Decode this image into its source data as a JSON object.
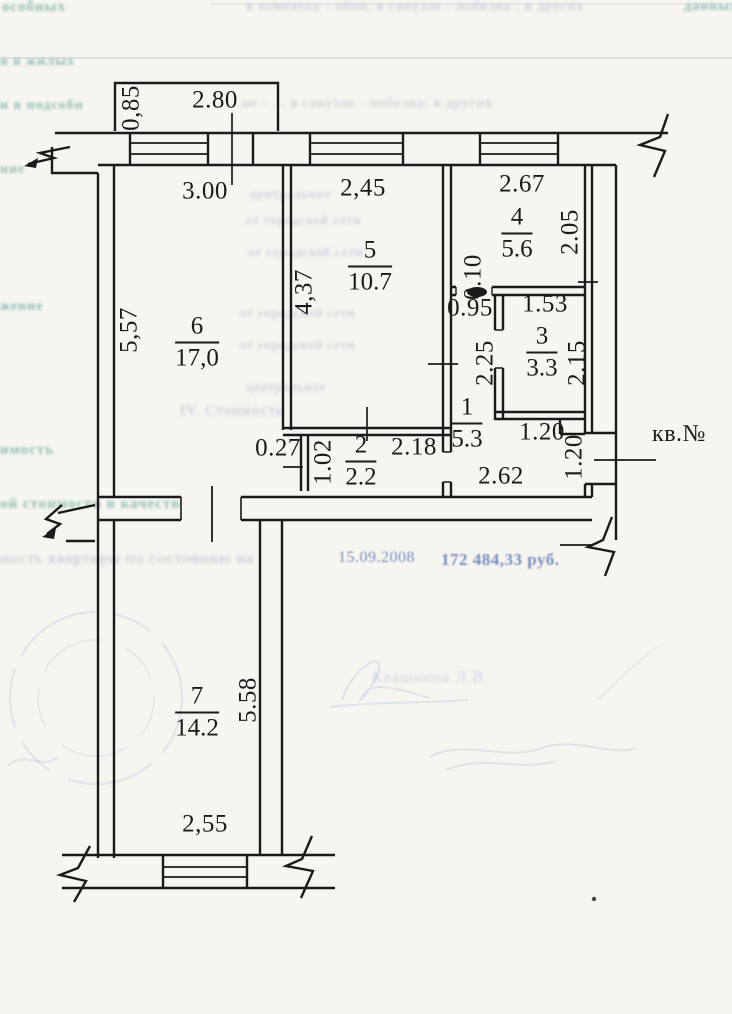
{
  "canvas": {
    "width": 732,
    "height": 1014,
    "paper_color": "#f7f5ef",
    "ink_color": "#1a1a1a",
    "bleed_teal": "#3d948d",
    "bleed_blue": "#8a99c9",
    "bleed_dark_blue": "#5570b4",
    "stamp_blue": "#7494cc"
  },
  "plan": {
    "apartment_label": {
      "text": "кв.№",
      "x": 679,
      "y": 434
    },
    "room_labels": [
      {
        "number": "6",
        "area": "17,0",
        "x": 197,
        "y": 342
      },
      {
        "number": "5",
        "area": "10.7",
        "x": 370,
        "y": 266
      },
      {
        "number": "4",
        "area": "5.6",
        "x": 517,
        "y": 233
      },
      {
        "number": "3",
        "area": "3.3",
        "x": 542,
        "y": 352
      },
      {
        "number": "1",
        "area": "5.3",
        "x": 467,
        "y": 423
      },
      {
        "number": "2",
        "area": "2.2",
        "x": 361,
        "y": 461
      },
      {
        "number": "7",
        "area": "14.2",
        "x": 197,
        "y": 712
      }
    ],
    "dimensions": [
      {
        "text": "0,85",
        "x": 131,
        "y": 108,
        "rot": -90
      },
      {
        "text": "2.80",
        "x": 215,
        "y": 100,
        "rot": 0
      },
      {
        "text": "3.00",
        "x": 205,
        "y": 191,
        "rot": 0
      },
      {
        "text": "2,45",
        "x": 363,
        "y": 188,
        "rot": 0
      },
      {
        "text": "2.67",
        "x": 522,
        "y": 184,
        "rot": 0
      },
      {
        "text": "4,37",
        "x": 304,
        "y": 292,
        "rot": -90
      },
      {
        "text": "5,57",
        "x": 129,
        "y": 330,
        "rot": -90
      },
      {
        "text": "2.05",
        "x": 570,
        "y": 232,
        "rot": -90
      },
      {
        "text": "0.10",
        "x": 473,
        "y": 277,
        "rot": -90
      },
      {
        "text": "0.95",
        "x": 470,
        "y": 308,
        "rot": 0
      },
      {
        "text": "1.53",
        "x": 545,
        "y": 304,
        "rot": 0
      },
      {
        "text": "2.25",
        "x": 485,
        "y": 363,
        "rot": -90
      },
      {
        "text": "2.15",
        "x": 577,
        "y": 363,
        "rot": -90
      },
      {
        "text": "0.27",
        "x": 278,
        "y": 448,
        "rot": 0
      },
      {
        "text": "1.02",
        "x": 323,
        "y": 462,
        "rot": -90
      },
      {
        "text": "2.18",
        "x": 414,
        "y": 447,
        "rot": 0
      },
      {
        "text": "2.62",
        "x": 501,
        "y": 476,
        "rot": 0
      },
      {
        "text": "1.20",
        "x": 542,
        "y": 432,
        "rot": 0
      },
      {
        "text": "1.20",
        "x": 574,
        "y": 457,
        "rot": -90
      },
      {
        "text": "5.58",
        "x": 248,
        "y": 700,
        "rot": -90
      },
      {
        "text": "2,55",
        "x": 205,
        "y": 824,
        "rot": 0
      }
    ]
  },
  "bleed": {
    "lines": [
      {
        "text": "особных",
        "x": 2,
        "y": 0,
        "size": 15,
        "color": "teal",
        "bold": true
      },
      {
        "text": "в комнатах - обои, в санузле - побелка ; в других",
        "x": 246,
        "y": 0,
        "size": 14,
        "color": "blue"
      },
      {
        "text": "данных",
        "x": 684,
        "y": 0,
        "size": 14,
        "color": "teal",
        "bold": true
      },
      {
        "text": "я в жилых",
        "x": 0,
        "y": 55,
        "size": 14,
        "color": "teal",
        "bold": true
      },
      {
        "text": "и в подсобн",
        "x": 0,
        "y": 99,
        "size": 14,
        "color": "teal",
        "bold": true
      },
      {
        "text": "не - ... в санузле - побелка; в других",
        "x": 242,
        "y": 97,
        "size": 14,
        "color": "blue"
      },
      {
        "text": "ние",
        "x": 0,
        "y": 163,
        "size": 14,
        "color": "teal",
        "bold": true
      },
      {
        "text": "центральное",
        "x": 250,
        "y": 187,
        "size": 13,
        "color": "blue"
      },
      {
        "text": "от городской сети",
        "x": 246,
        "y": 213,
        "size": 13,
        "color": "blue"
      },
      {
        "text": "от городской сети",
        "x": 248,
        "y": 245,
        "size": 13,
        "color": "blue"
      },
      {
        "text": "жение",
        "x": 0,
        "y": 300,
        "size": 14,
        "color": "teal",
        "bold": true
      },
      {
        "text": "от городской сети",
        "x": 240,
        "y": 306,
        "size": 13,
        "color": "blue"
      },
      {
        "text": "от городской сети",
        "x": 240,
        "y": 338,
        "size": 13,
        "color": "blue"
      },
      {
        "text": "центральное",
        "x": 246,
        "y": 380,
        "size": 13,
        "color": "blue"
      },
      {
        "text": "IV. Стоимость",
        "x": 180,
        "y": 404,
        "size": 15,
        "color": "blue"
      },
      {
        "text": "имость",
        "x": 0,
        "y": 443,
        "size": 15,
        "color": "teal",
        "bold": true
      },
      {
        "text": "ой стоимости в качестве жилья",
        "x": 0,
        "y": 497,
        "size": 15,
        "color": "teal",
        "bold": true
      },
      {
        "text": "ность квартиры по состоянию на",
        "x": 0,
        "y": 551,
        "size": 16,
        "color": "blue"
      },
      {
        "text": "15.09.2008",
        "x": 338,
        "y": 550,
        "size": 16,
        "color": "darkblue"
      },
      {
        "text": "172 484,33 руб.",
        "x": 441,
        "y": 551,
        "size": 17,
        "color": "darkblue",
        "bold": true
      },
      {
        "text": "Квашнина Л.В.",
        "x": 372,
        "y": 670,
        "size": 16,
        "color": "lightblue"
      }
    ]
  }
}
